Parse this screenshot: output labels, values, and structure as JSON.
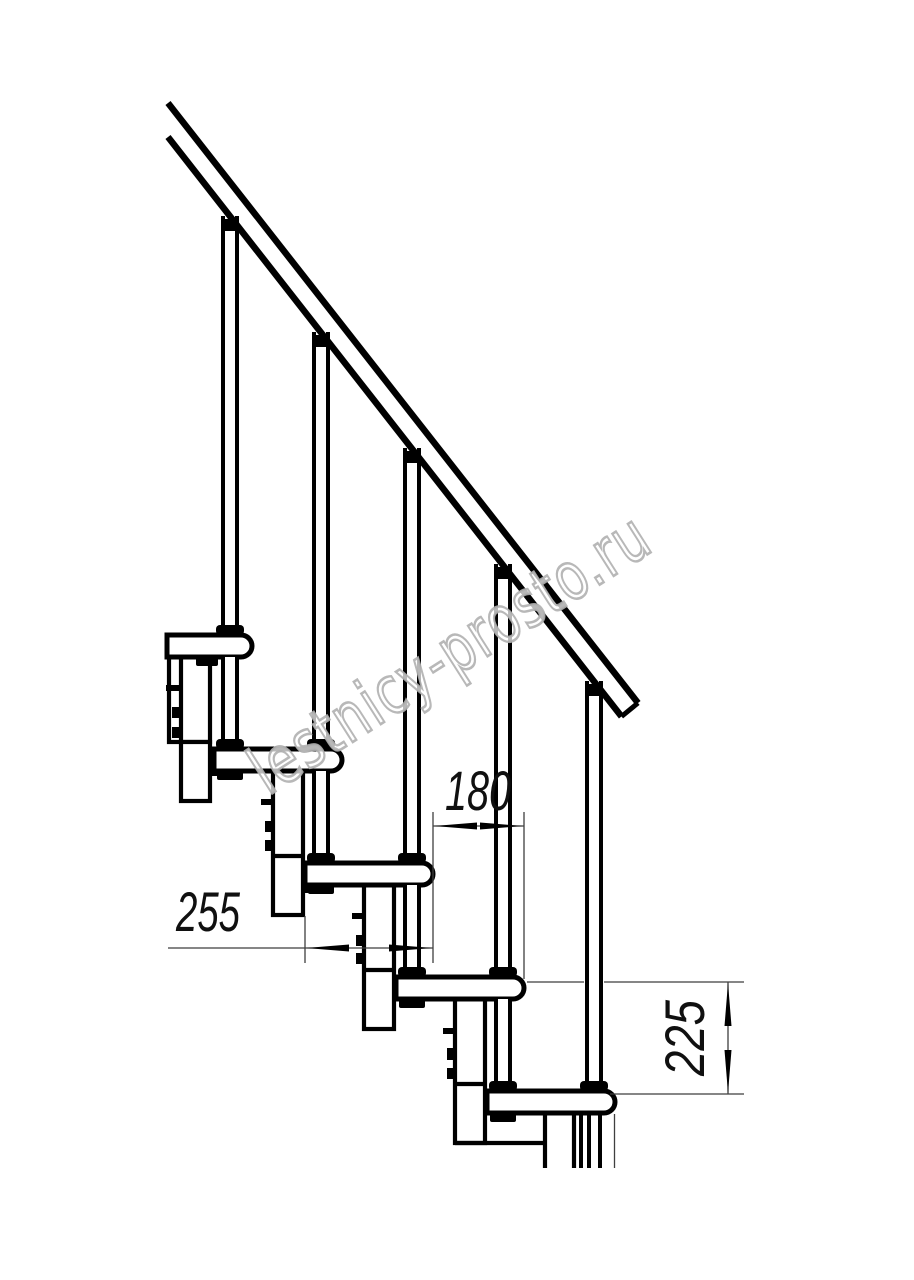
{
  "watermark": {
    "text": "lestnicy-prosto.ru",
    "color": "#b0b0b0"
  },
  "dimensions": [
    {
      "id": "step-run",
      "label": "180",
      "orientation": "horizontal"
    },
    {
      "id": "tread-depth",
      "label": "255",
      "orientation": "horizontal"
    },
    {
      "id": "step-rise",
      "label": "225",
      "orientation": "vertical"
    }
  ],
  "drawing": {
    "subject": "modular staircase side view with handrail, balusters, treads and central support columns",
    "ink": "#000000",
    "thin_line": "#3f3f3f",
    "background": "#ffffff"
  }
}
